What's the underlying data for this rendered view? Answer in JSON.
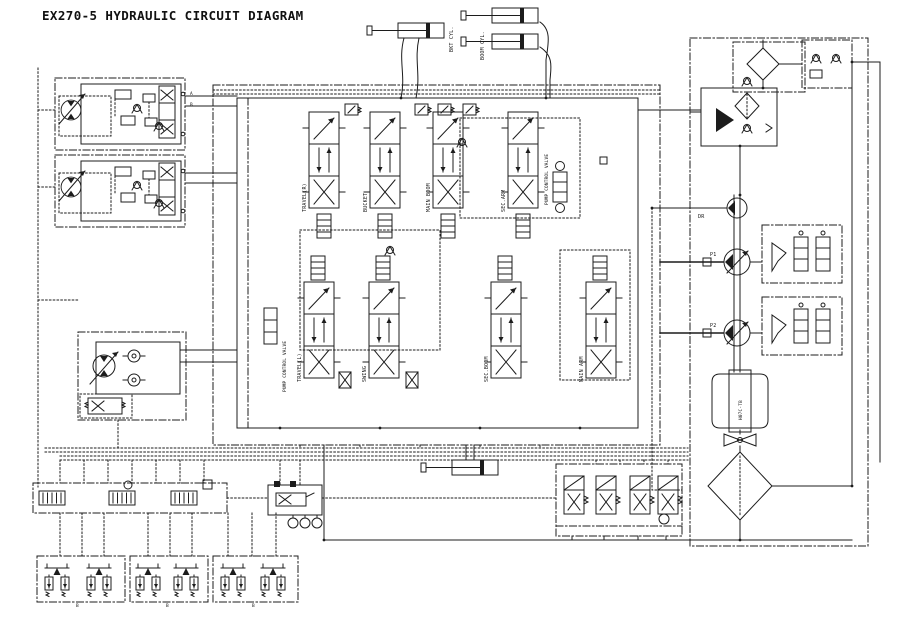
{
  "title": "EX270-5 HYDRAULIC CIRCUIT DIAGRAM",
  "colors": {
    "ink": "#1c1c1c",
    "background": "#ffffff"
  },
  "cylinders": {
    "bucket": "BKT CYL.",
    "boom": "BOOM CYL."
  },
  "main_valve": {
    "pump_control_top": "PUMP CONTROL VALVE",
    "pump_control_left": "PUMP CONTROL VALVE",
    "top_row": [
      {
        "label": "TRAVEL(R)"
      },
      {
        "label": "BUCKET"
      },
      {
        "label": "MAIN BOOM"
      },
      {
        "label": "SEC.ARM"
      }
    ],
    "bottom_row": [
      {
        "label": "TRAVEL(L)"
      },
      {
        "label": "SWING"
      },
      {
        "label": "SEC.BOOM"
      },
      {
        "label": "MAIN ARM"
      }
    ]
  },
  "engine": {
    "model": "H07C-TB"
  },
  "ports": {
    "p1": "P1",
    "p2": "P2",
    "dr": "DR",
    "a": "A",
    "b": "B"
  }
}
